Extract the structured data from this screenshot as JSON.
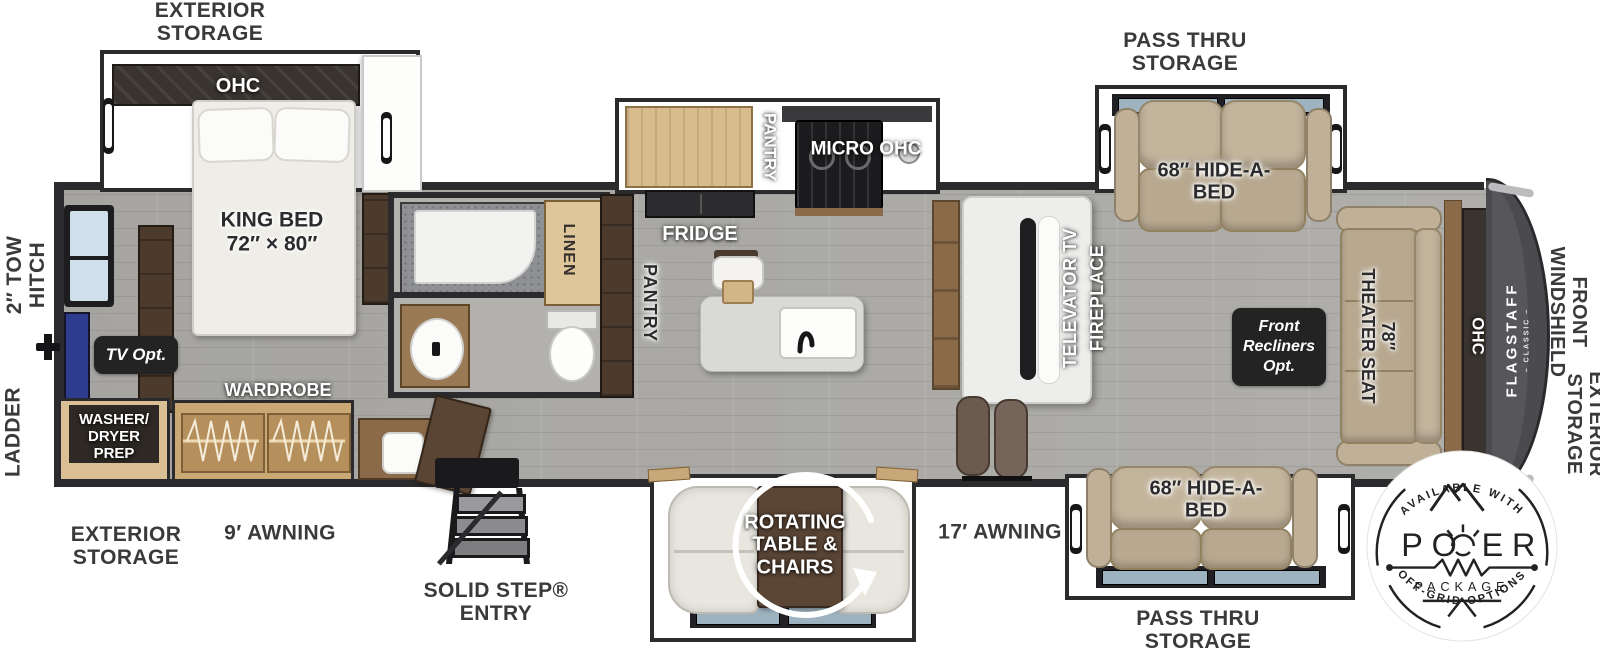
{
  "colors": {
    "wall": "#2b2b2d",
    "floor_gray": "#acaba7",
    "floor_brown": "#8d7460",
    "sofa_tan": "#b7a88f",
    "wood_tan": "#d8bc8e",
    "wood_brown": "#8a6a49",
    "cap_gray": "#4b4b4f",
    "badge_dark": "#232323",
    "tv_blue": "#2e3c8f"
  },
  "labels": {
    "top_left_storage": "EXTERIOR\nSTORAGE",
    "tow_hitch": "2″ TOW\nHITCH",
    "ladder": "LADDER",
    "pass_thru_top": "PASS THRU\nSTORAGE",
    "pass_thru_bottom": "PASS THRU\nSTORAGE",
    "awning_9": "9′ AWNING",
    "awning_17": "17′ AWNING",
    "bottom_left_storage": "EXTERIOR\nSTORAGE",
    "solid_step": "SOLID STEP®\nENTRY",
    "front_windshield": "FRONT\nWINDSHIELD",
    "right_storage": "EXTERIOR\nSTORAGE"
  },
  "bedroom": {
    "ohc": "OHC",
    "king_bed": "KING BED\n72″ × 80″",
    "wardrobe": "WARDROBE",
    "tv_opt": "TV Opt.",
    "washer_dryer": "WASHER/\nDRYER\nPREP"
  },
  "bath": {
    "linen": "LINEN"
  },
  "kitchen": {
    "pantry_left": "PANTRY",
    "pantry_top": "PANTRY",
    "micro_ohc": "MICRO OHC",
    "fridge": "FRIDGE"
  },
  "living": {
    "televator_tv": "TELEVATOR TV",
    "fireplace": "FIREPLACE",
    "hide_a_bed_top": "68″ HIDE-A-\nBED",
    "hide_a_bed_bottom": "68″ HIDE-A-\nBED",
    "front_recliners": "Front\nRecliners\nOpt.",
    "theater_seat": "78″\nTHEATER SEAT",
    "ohc_front": "OHC"
  },
  "dinette": {
    "rotating": "ROTATING\nTABLE &\nCHAIRS"
  },
  "brand": {
    "flagstaff": "FLAGSTAFF",
    "classic": "– CLASSIC –"
  },
  "badge": {
    "available_with": "AVAILABLE WITH",
    "power_left": "PO",
    "power_right": "ER",
    "package": "PACKAGE",
    "off_grid": "OFF-GRID OPTIONS"
  }
}
